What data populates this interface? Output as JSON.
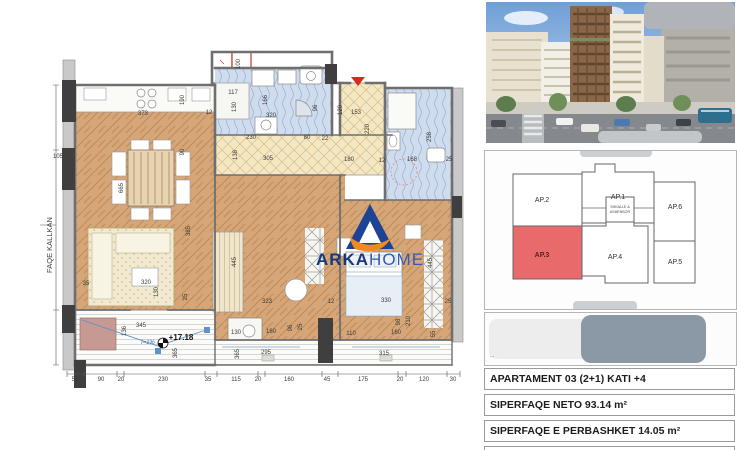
{
  "plan": {
    "side_label": "FAQE KALLKAN",
    "logo": {
      "word1": "ARKA",
      "word2": "HOME"
    },
    "dimensions": [
      {
        "t": "373",
        "x": 143,
        "y": 114
      },
      {
        "t": "190",
        "x": 183,
        "y": 100,
        "r": 1
      },
      {
        "t": "90",
        "x": 183,
        "y": 152,
        "r": 1
      },
      {
        "t": "105",
        "x": 58,
        "y": 157
      },
      {
        "t": "665",
        "x": 122,
        "y": 188,
        "r": 1
      },
      {
        "t": "385",
        "x": 189,
        "y": 231,
        "r": 1
      },
      {
        "t": "100",
        "x": 239,
        "y": 64,
        "r": 1
      },
      {
        "t": "117",
        "x": 233,
        "y": 93
      },
      {
        "t": "130",
        "x": 235,
        "y": 107,
        "r": 1
      },
      {
        "t": "166",
        "x": 266,
        "y": 100,
        "r": 1
      },
      {
        "t": "320",
        "x": 271,
        "y": 116
      },
      {
        "t": "12",
        "x": 209,
        "y": 113
      },
      {
        "t": "96",
        "x": 316,
        "y": 108,
        "r": 1
      },
      {
        "t": "120",
        "x": 341,
        "y": 110,
        "r": 1
      },
      {
        "t": "153",
        "x": 356,
        "y": 113
      },
      {
        "t": "220",
        "x": 368,
        "y": 129,
        "r": 1
      },
      {
        "t": "230",
        "x": 251,
        "y": 138
      },
      {
        "t": "80",
        "x": 307,
        "y": 138
      },
      {
        "t": "22",
        "x": 325,
        "y": 139
      },
      {
        "t": "138",
        "x": 236,
        "y": 155,
        "r": 1
      },
      {
        "t": "305",
        "x": 268,
        "y": 159
      },
      {
        "t": "180",
        "x": 349,
        "y": 160
      },
      {
        "t": "12",
        "x": 382,
        "y": 161
      },
      {
        "t": "168",
        "x": 412,
        "y": 160
      },
      {
        "t": "25",
        "x": 449,
        "y": 160
      },
      {
        "t": "258",
        "x": 430,
        "y": 137,
        "r": 1
      },
      {
        "t": "35",
        "x": 86,
        "y": 284
      },
      {
        "t": "320",
        "x": 146,
        "y": 283
      },
      {
        "t": "130",
        "x": 157,
        "y": 292,
        "r": 1
      },
      {
        "t": "25",
        "x": 186,
        "y": 297,
        "r": 1
      },
      {
        "t": "445",
        "x": 235,
        "y": 262,
        "r": 1
      },
      {
        "t": "445",
        "x": 431,
        "y": 263,
        "r": 1
      },
      {
        "t": "323",
        "x": 267,
        "y": 302
      },
      {
        "t": "12",
        "x": 331,
        "y": 302
      },
      {
        "t": "330",
        "x": 386,
        "y": 301
      },
      {
        "t": "25",
        "x": 448,
        "y": 302
      },
      {
        "t": "345",
        "x": 141,
        "y": 326
      },
      {
        "t": "136",
        "x": 125,
        "y": 331,
        "r": 1
      },
      {
        "t": "+17.18",
        "x": 181,
        "y": 338,
        "c": "level"
      },
      {
        "t": "i=1%",
        "x": 148,
        "y": 343,
        "c": "slope"
      },
      {
        "t": "130",
        "x": 236,
        "y": 333
      },
      {
        "t": "160",
        "x": 271,
        "y": 332
      },
      {
        "t": "96",
        "x": 291,
        "y": 328,
        "r": 1
      },
      {
        "t": "25",
        "x": 301,
        "y": 327,
        "r": 1
      },
      {
        "t": "110",
        "x": 351,
        "y": 334
      },
      {
        "t": "160",
        "x": 396,
        "y": 333
      },
      {
        "t": "98",
        "x": 399,
        "y": 322,
        "r": 1
      },
      {
        "t": "210",
        "x": 409,
        "y": 321,
        "r": 1
      },
      {
        "t": "55",
        "x": 434,
        "y": 334,
        "r": 1
      },
      {
        "t": "295",
        "x": 266,
        "y": 353
      },
      {
        "t": "365",
        "x": 238,
        "y": 354,
        "r": 1
      },
      {
        "t": "315",
        "x": 384,
        "y": 354
      },
      {
        "t": "365",
        "x": 176,
        "y": 353,
        "r": 1
      },
      {
        "t": "50",
        "x": 75,
        "y": 380
      },
      {
        "t": "90",
        "x": 101,
        "y": 380
      },
      {
        "t": "20",
        "x": 121,
        "y": 380
      },
      {
        "t": "230",
        "x": 163,
        "y": 380
      },
      {
        "t": "35",
        "x": 208,
        "y": 380
      },
      {
        "t": "115",
        "x": 236,
        "y": 380
      },
      {
        "t": "20",
        "x": 258,
        "y": 380
      },
      {
        "t": "160",
        "x": 289,
        "y": 380
      },
      {
        "t": "45",
        "x": 327,
        "y": 380
      },
      {
        "t": "175",
        "x": 363,
        "y": 380
      },
      {
        "t": "20",
        "x": 400,
        "y": 380
      },
      {
        "t": "120",
        "x": 424,
        "y": 380
      },
      {
        "t": "30",
        "x": 453,
        "y": 380
      }
    ]
  },
  "sidebar": {
    "keyplan": {
      "units": [
        {
          "label": "AP.2"
        },
        {
          "label": "AP.1"
        },
        {
          "label": "AP.6"
        },
        {
          "label": "AP.3"
        },
        {
          "label": "AP.4"
        },
        {
          "label": "AP.5"
        }
      ],
      "highlighted": "AP.3",
      "core_line1": "SHKALLE &",
      "core_line2": "ASHENSOR"
    },
    "info_rows": [
      {
        "text": "APARTAMENT 03  (2+1) KATI +4"
      },
      {
        "text": "SIPERFAQE NETO  93.14 m²"
      },
      {
        "text": "SIPERFAQE E PERBASHKET 14.05 m²"
      },
      {
        "text": "SIPERFAQE BRUTO 107.19 m²"
      }
    ]
  },
  "colors": {
    "unit_highlight": "#e96a6a",
    "logo_blue": "#16387f",
    "logo_light_blue": "#2f5cb4",
    "logo_orange": "#f08a1d",
    "entry_marker_red": "#d42b1f"
  }
}
